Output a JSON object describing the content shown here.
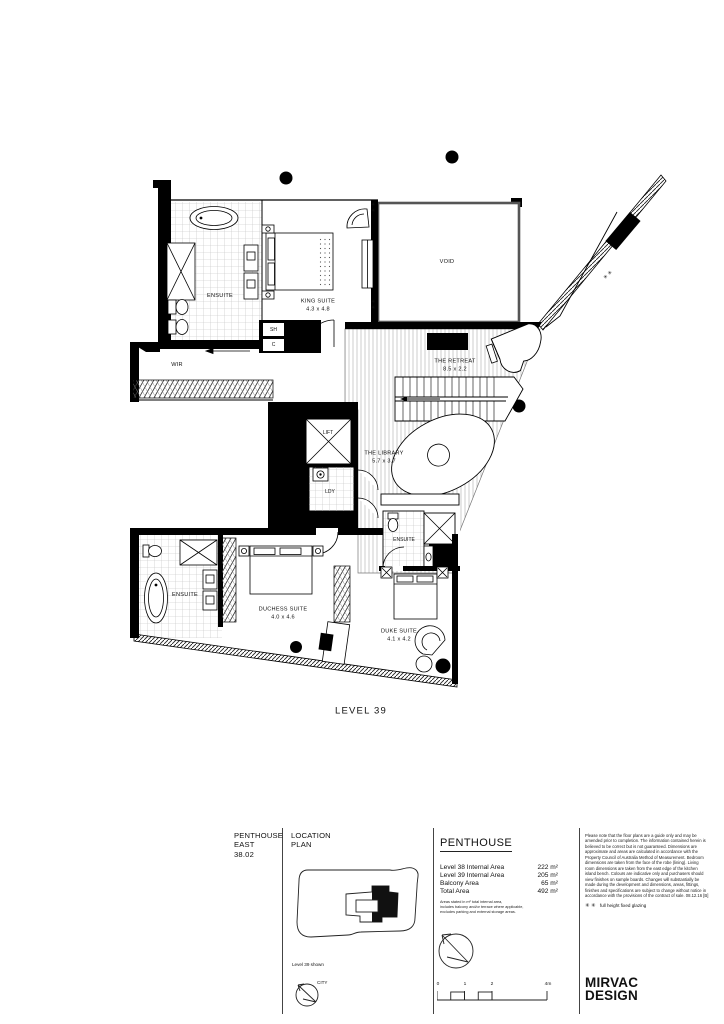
{
  "plan": {
    "level_label": "LEVEL 39",
    "glazing_pair": "✳\n✳",
    "rooms": [
      {
        "id": "ensuite-king",
        "label": "ENSUITE",
        "dims": ""
      },
      {
        "id": "king-suite",
        "label": "KING SUITE",
        "dims": "4.3 x 4.8"
      },
      {
        "id": "void",
        "label": "VOID",
        "dims": ""
      },
      {
        "id": "wir",
        "label": "WIR",
        "dims": ""
      },
      {
        "id": "shower",
        "label": "SH",
        "dims": ""
      },
      {
        "id": "cupboard",
        "label": "C",
        "dims": ""
      },
      {
        "id": "retreat",
        "label": "THE RETREAT",
        "dims": "8.5 x 2.2"
      },
      {
        "id": "library",
        "label": "THE LIBRARY",
        "dims": "5.7 x 3.7"
      },
      {
        "id": "lift",
        "label": "LIFT",
        "dims": ""
      },
      {
        "id": "laundry",
        "label": "LDY",
        "dims": ""
      },
      {
        "id": "ensuite-duke",
        "label": "ENSUITE",
        "dims": ""
      },
      {
        "id": "ensuite-duchess",
        "label": "ENSUITE",
        "dims": ""
      },
      {
        "id": "duchess-suite",
        "label": "DUCHESS SUITE",
        "dims": "4.0 x 4.6"
      },
      {
        "id": "duke-suite",
        "label": "DUKE SUITE",
        "dims": "4.1 x 4.2"
      }
    ]
  },
  "titleblock": {
    "apartment": {
      "line1": "PENTHOUSE",
      "line2": "EAST",
      "number": "38.02"
    },
    "location_plan": {
      "line1": "LOCATION",
      "line2": "PLAN",
      "caption": "Level 39 shown",
      "compass_label": "CITY"
    },
    "areas": {
      "heading": "PENTHOUSE",
      "rows": [
        {
          "label": "Level 38 Internal Area",
          "value": "222 m²"
        },
        {
          "label": "Level 39 Internal Area",
          "value": "205 m²"
        },
        {
          "label": "Balcony Area",
          "value": "65 m²"
        },
        {
          "label": "Total Area",
          "value": "492 m²"
        }
      ],
      "notes_line1": "Areas stated in m² total internal area,",
      "notes_line2": "includes balcony and/or terrace where applicable,",
      "notes_line3": "excludes parking and external storage areas."
    },
    "scale_bar": {
      "tick0": "0",
      "tick1": "1",
      "tick2": "2",
      "tick3": "4m"
    },
    "disclaimer": "Please note that the floor plans are a guide only and may be amended prior to completion. The information contained herein is believed to be correct but is not guaranteed. Dimensions are approximate and areas are calculated in accordance with the Property Council of Australia Method of Measurement. Bedroom dimensions are taken from the face of the robe (lining). Living room dimensions are taken from the east edge of the kitchen island bench. Colours are indicative only and purchasers should view finishes on sample boards. Changes will substantially be made during the development and dimensions, areas, fittings, finishes and specifications are subject to change without notice in accordance with the provisions of the contract of sale. 08.12.16 [B]",
    "glazing_note_symbols": "✳ ✳",
    "glazing_note_text": "full height fixed glazing",
    "logo_line1": "MIRVAC",
    "logo_line2": "DESIGN"
  }
}
